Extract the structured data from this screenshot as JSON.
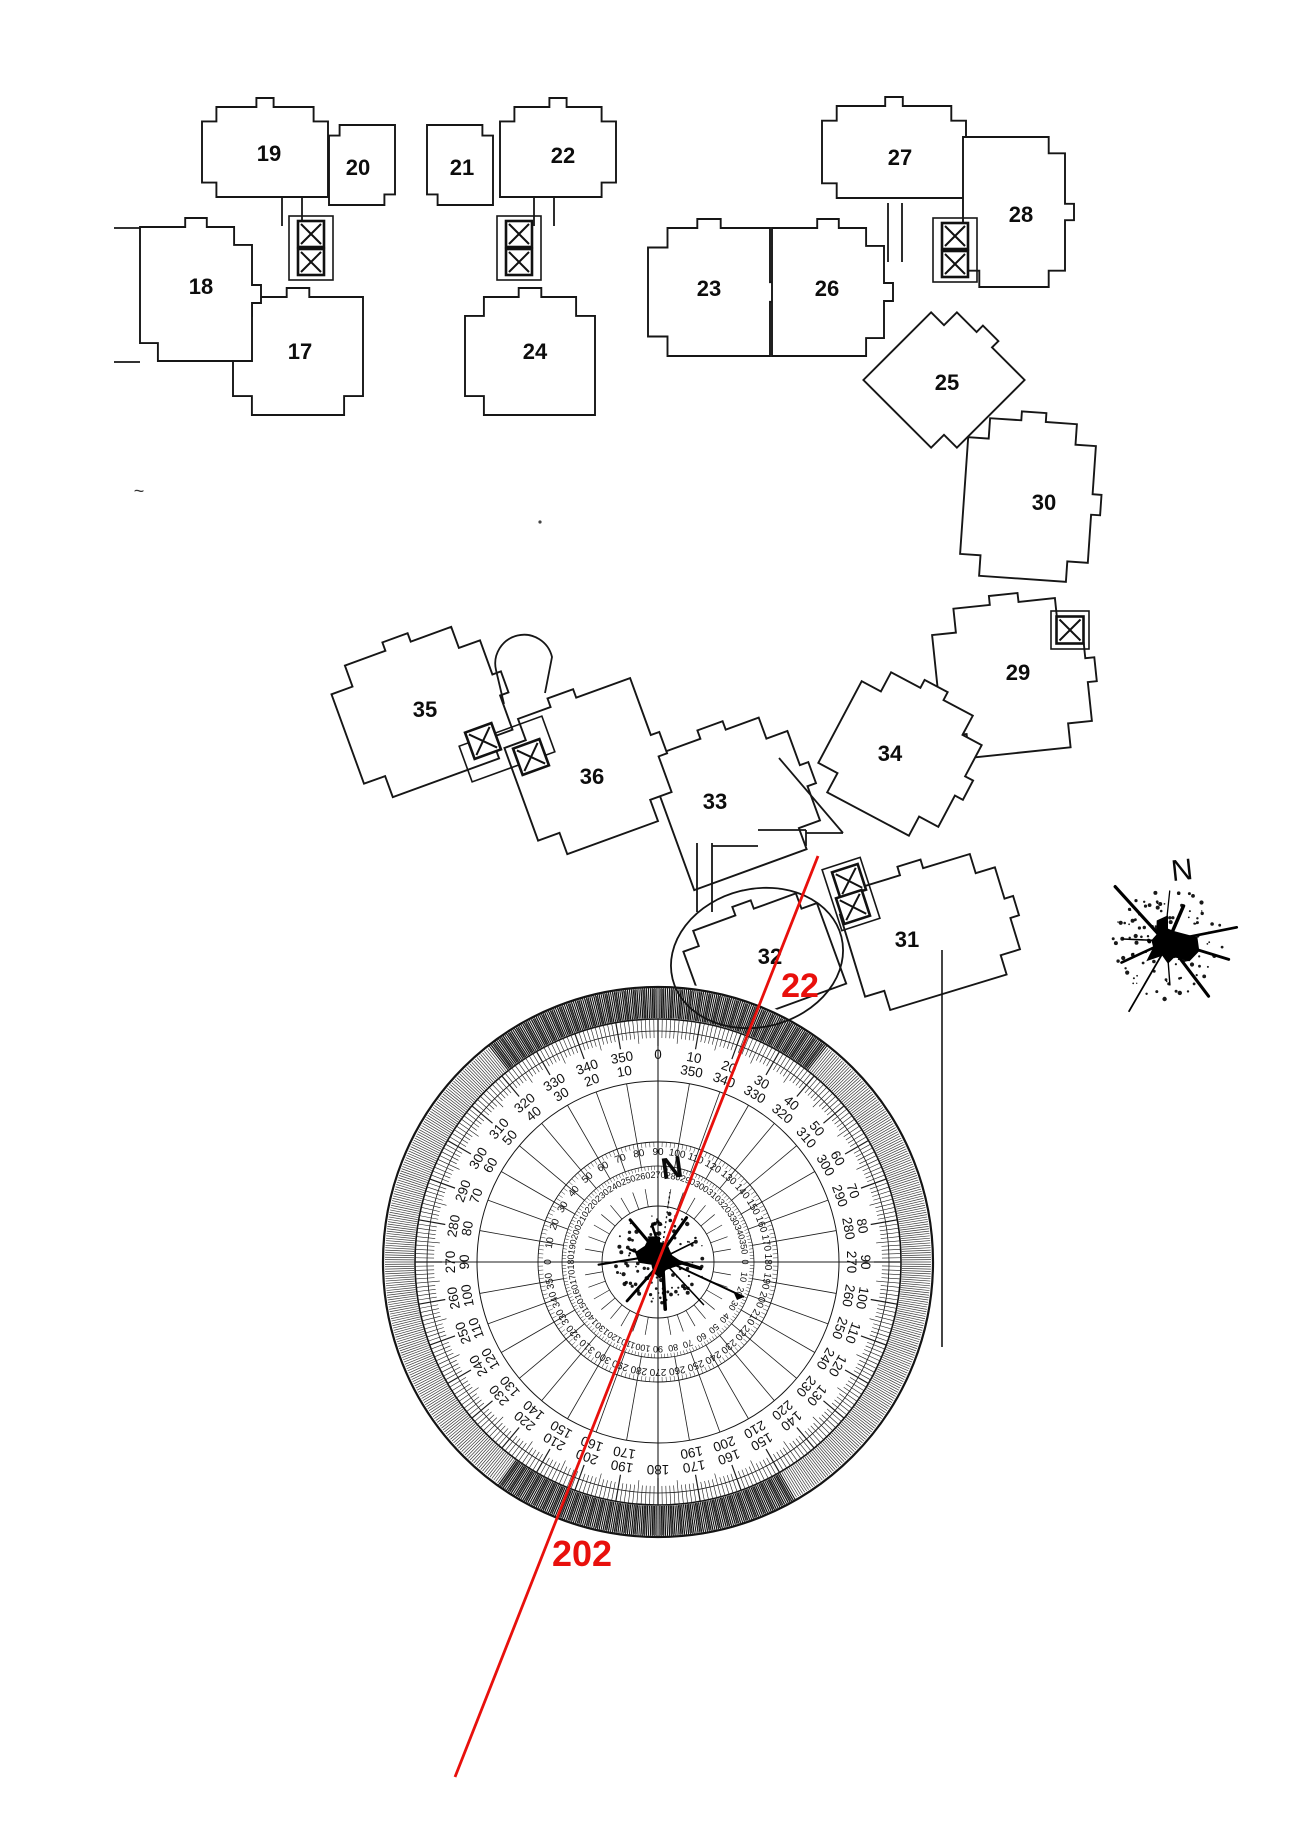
{
  "floor_plan": {
    "rooms": [
      {
        "number": "17",
        "label_x": 300,
        "label_y": 359
      },
      {
        "number": "18",
        "label_x": 201,
        "label_y": 294
      },
      {
        "number": "19",
        "label_x": 269,
        "label_y": 161
      },
      {
        "number": "20",
        "label_x": 358,
        "label_y": 175
      },
      {
        "number": "21",
        "label_x": 462,
        "label_y": 175
      },
      {
        "number": "22",
        "label_x": 563,
        "label_y": 163
      },
      {
        "number": "23",
        "label_x": 709,
        "label_y": 296
      },
      {
        "number": "24",
        "label_x": 535,
        "label_y": 359
      },
      {
        "number": "25",
        "label_x": 947,
        "label_y": 390
      },
      {
        "number": "26",
        "label_x": 827,
        "label_y": 296
      },
      {
        "number": "27",
        "label_x": 900,
        "label_y": 165
      },
      {
        "number": "28",
        "label_x": 1021,
        "label_y": 222
      },
      {
        "number": "29",
        "label_x": 1018,
        "label_y": 680
      },
      {
        "number": "30",
        "label_x": 1044,
        "label_y": 510
      },
      {
        "number": "31",
        "label_x": 907,
        "label_y": 947
      },
      {
        "number": "32",
        "label_x": 770,
        "label_y": 964
      },
      {
        "number": "33",
        "label_x": 715,
        "label_y": 809
      },
      {
        "number": "34",
        "label_x": 890,
        "label_y": 761
      },
      {
        "number": "35",
        "label_x": 425,
        "label_y": 717
      },
      {
        "number": "36",
        "label_x": 592,
        "label_y": 784
      }
    ]
  },
  "north_indicator": {
    "label": "N"
  },
  "protractor": {
    "center_label": "N",
    "outer_ring": [
      [
        0,
        "0",
        ""
      ],
      [
        10,
        "10",
        "350"
      ],
      [
        20,
        "20",
        "340"
      ],
      [
        30,
        "30",
        "330"
      ],
      [
        40,
        "40",
        "320"
      ],
      [
        50,
        "50",
        "310"
      ],
      [
        60,
        "60",
        "300"
      ],
      [
        70,
        "70",
        "290"
      ],
      [
        80,
        "80",
        "280"
      ],
      [
        90,
        "90",
        "270"
      ],
      [
        100,
        "100",
        "260"
      ],
      [
        110,
        "110",
        "250"
      ],
      [
        120,
        "120",
        "240"
      ],
      [
        130,
        "130",
        "230"
      ],
      [
        140,
        "140",
        "220"
      ],
      [
        150,
        "150",
        "210"
      ],
      [
        160,
        "160",
        "200"
      ],
      [
        170,
        "170",
        "190"
      ],
      [
        180,
        "180",
        ""
      ],
      [
        190,
        "190",
        "170"
      ],
      [
        200,
        "200",
        "160"
      ],
      [
        210,
        "210",
        "150"
      ],
      [
        220,
        "220",
        "140"
      ],
      [
        230,
        "230",
        "130"
      ],
      [
        240,
        "240",
        "120"
      ],
      [
        250,
        "250",
        "110"
      ],
      [
        260,
        "260",
        "100"
      ],
      [
        270,
        "270",
        "90"
      ],
      [
        280,
        "280",
        "80"
      ],
      [
        290,
        "290",
        "70"
      ],
      [
        300,
        "300",
        "60"
      ],
      [
        310,
        "310",
        "50"
      ],
      [
        320,
        "320",
        "40"
      ],
      [
        330,
        "330",
        "30"
      ],
      [
        340,
        "340",
        "20"
      ],
      [
        350,
        "350",
        "10"
      ]
    ],
    "middle_ring": [
      "90",
      "100",
      "110",
      "120",
      "130",
      "140",
      "150",
      "160",
      "170",
      "180",
      "190",
      "200",
      "210",
      "220",
      "230",
      "240",
      "250",
      "260",
      "270",
      "280",
      "290",
      "300",
      "310",
      "320",
      "330",
      "340",
      "350",
      "0",
      "10",
      "20",
      "30",
      "40",
      "50",
      "60",
      "70",
      "80"
    ],
    "inner_ring": [
      "270",
      "280",
      "290",
      "300",
      "310",
      "320",
      "330",
      "340",
      "350",
      "0",
      "10",
      "20",
      "30",
      "40",
      "50",
      "60",
      "70",
      "80",
      "90",
      "100",
      "110",
      "120",
      "130",
      "140",
      "150",
      "160",
      "170",
      "180",
      "190",
      "200",
      "210",
      "220",
      "230",
      "240",
      "250",
      "260"
    ]
  },
  "annotations": {
    "bearing_top_label": "22",
    "bearing_bottom_label": "202",
    "line_color": "#e8100c",
    "circled_room": "32"
  },
  "misc": {
    "tilde_mark": "~"
  }
}
